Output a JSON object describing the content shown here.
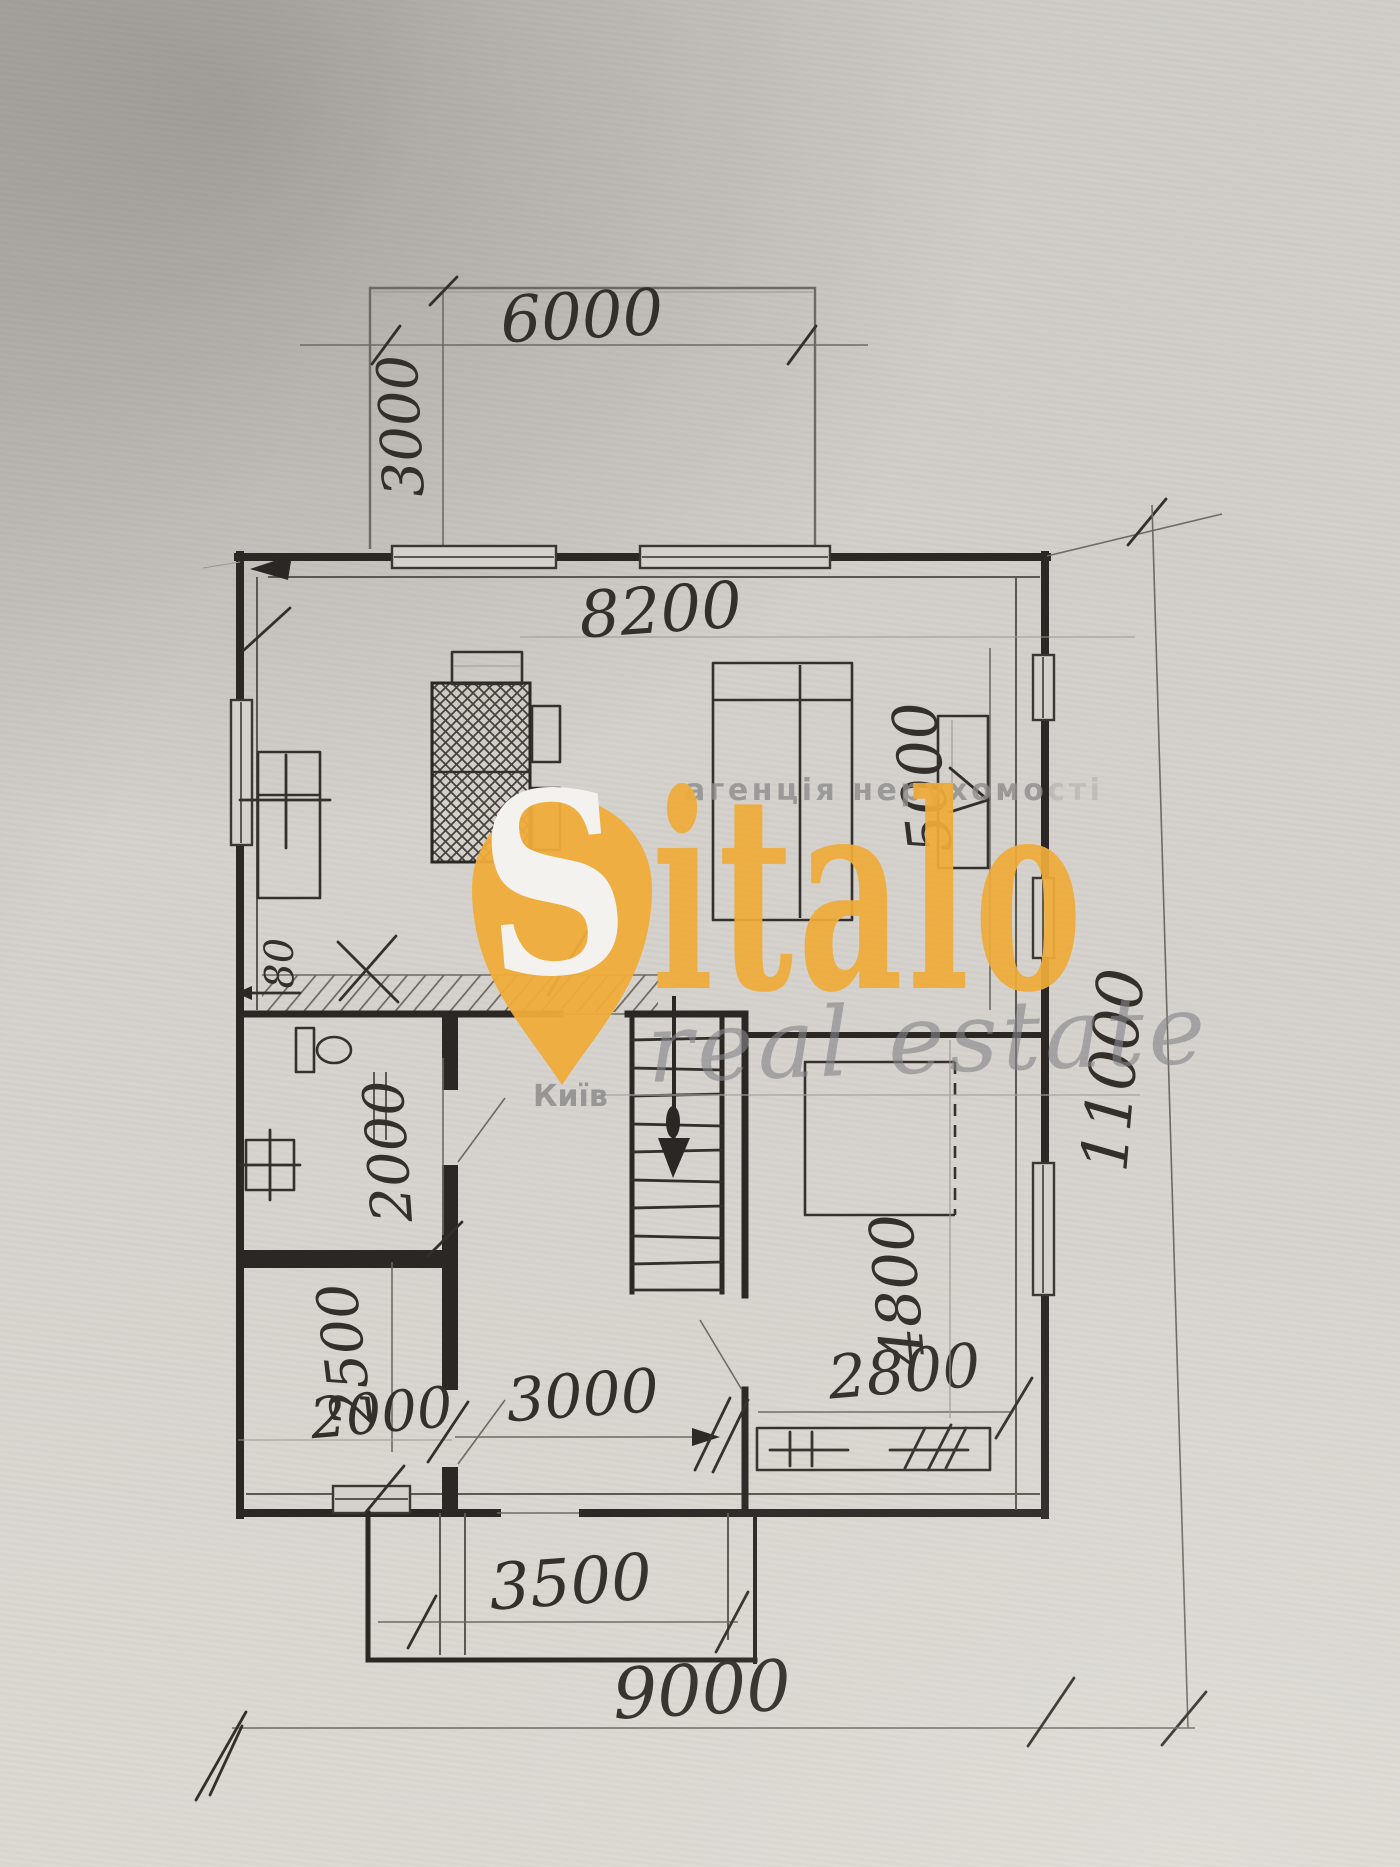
{
  "watermark": {
    "agency_text": "агенція нерухомо",
    "agency_text_faded": "сті",
    "logo_s": "S",
    "logo_rest": "italo",
    "tagline": "real estate",
    "city": "Київ",
    "orange": "#EFAC3A",
    "gray": "#8D8D8B"
  },
  "dimensions": {
    "terrace_width": "6000",
    "terrace_depth": "3000",
    "living_room_width": "8200",
    "living_room_depth": "5000",
    "house_depth": "11000",
    "house_width": "9000",
    "bathroom_depth": "2000",
    "left_room_width": "2000",
    "left_room_depth": "2500",
    "hall_width": "3000",
    "bedroom_width": "2800",
    "bedroom_depth": "4800",
    "porch_width": "3500",
    "wall_mark": "80"
  },
  "style": {
    "paper": "#d4d1cc",
    "pencil_dark": "#2a2724",
    "pencil_mid": "#55514b",
    "pencil_light": "#8a8680"
  }
}
